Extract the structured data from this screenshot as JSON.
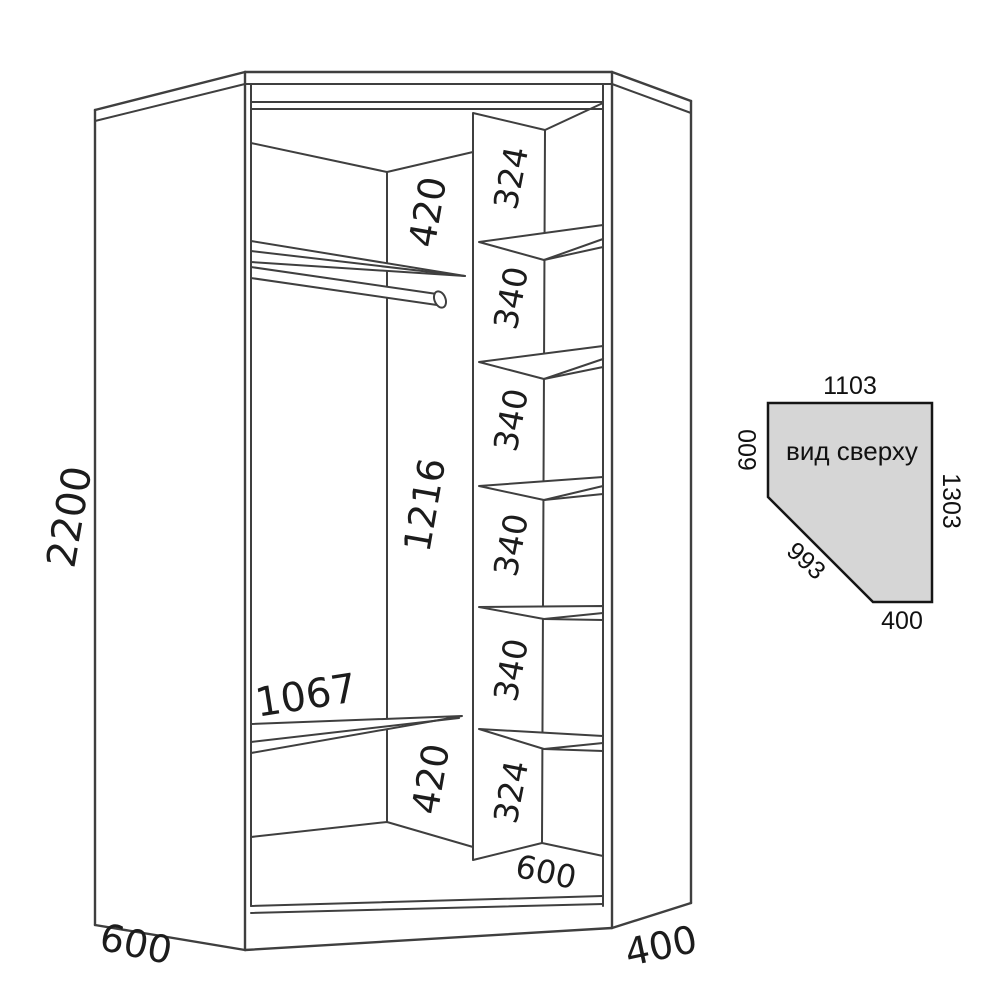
{
  "drawing": {
    "kind": "corner-wardrobe-dimension-diagram"
  },
  "front_view": {
    "height_total": "2200",
    "left_depth": "600",
    "right_depth": "400",
    "rod_section": {
      "top_gap": "420",
      "shelf_width": "1067",
      "middle_height": "1216",
      "bottom_gap": "420"
    },
    "shelf_column": {
      "sections": [
        "324",
        "340",
        "340",
        "340",
        "340",
        "324"
      ],
      "depth": "600"
    }
  },
  "top_view": {
    "title": "вид сверху",
    "top_width": "1103",
    "left_side": "600",
    "right_side": "1303",
    "diagonal": "993",
    "bottom_width": "400",
    "fill_color": "#d6d6d6"
  },
  "colors": {
    "line": "#3f3f3f",
    "text": "#1c1c1c",
    "background": "#ffffff"
  }
}
